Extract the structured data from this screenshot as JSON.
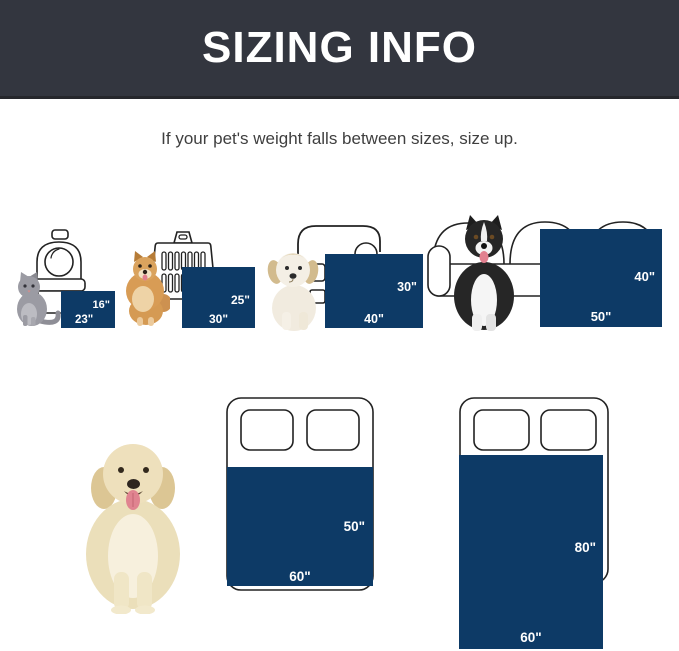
{
  "header": {
    "title": "SIZING INFO"
  },
  "subtitle": "If your pet's weight falls between sizes, size up.",
  "colors": {
    "header_bg": "#33363f",
    "blanket_navy": "#0d3a66",
    "label_text": "#ffffff",
    "outline": "#222222"
  },
  "sizes": [
    {
      "pet": "cat",
      "scene": "pet-carrier",
      "width_label": "23\"",
      "height_label": "16\""
    },
    {
      "pet": "pomeranian",
      "scene": "dog-crate",
      "width_label": "30\"",
      "height_label": "25\""
    },
    {
      "pet": "puppy",
      "scene": "armchair",
      "width_label": "40\"",
      "height_label": "30\""
    },
    {
      "pet": "border-collie",
      "scene": "sofa",
      "width_label": "50\"",
      "height_label": "40\""
    },
    {
      "pet": "golden-retriever",
      "scene": "bed",
      "width_label": "60\"",
      "height_label": "50\""
    },
    {
      "pet": "golden-retriever",
      "scene": "bed",
      "width_label": "60\"",
      "height_label": "80\""
    }
  ]
}
